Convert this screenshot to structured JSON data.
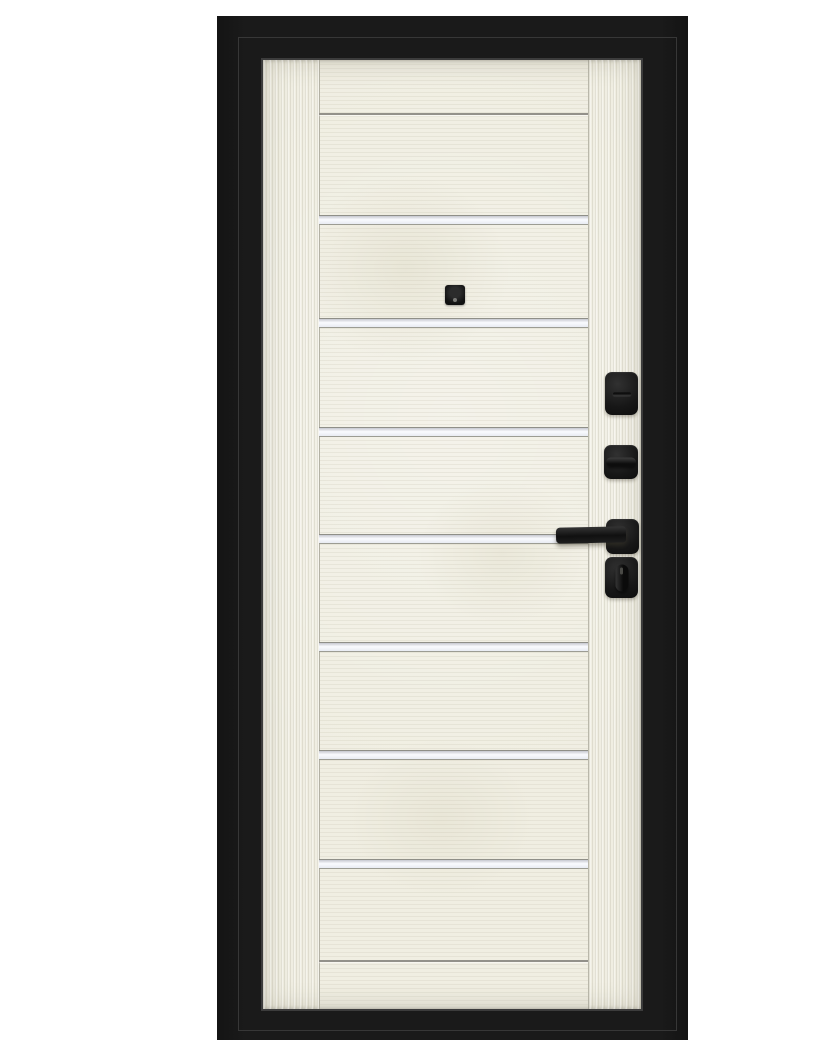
{
  "scene": {
    "description": "Product photo of an entrance door: black steel frame, light bleached-oak leaf with vertical side stiles, horizontal panel grooves with glossy light insert strips, square black peephole and four pieces of square black hardware (keyhole cover, thumbturn, lever handle, key cylinder) on the right stile"
  },
  "palette": {
    "background": "#ffffff",
    "frame": "#1a1a1a",
    "frame_highlight": "#3d3d3d",
    "wood": "#f0eee2",
    "groove_line": "#93918a",
    "insert_strip": "#fafbfe",
    "hardware": "#171717"
  },
  "door": {
    "leaf": {
      "x": 223,
      "y": 44,
      "w": 378,
      "h": 949
    },
    "stile_width_left": 56,
    "stile_width_right": 53,
    "grooves": [
      {
        "y": 97,
        "insert": false
      },
      {
        "y": 199,
        "insert": true
      },
      {
        "y": 302,
        "insert": true
      },
      {
        "y": 411,
        "insert": true
      },
      {
        "y": 518,
        "insert": true
      },
      {
        "y": 626,
        "insert": true
      },
      {
        "y": 734,
        "insert": true
      },
      {
        "y": 843,
        "insert": true
      },
      {
        "y": 944,
        "insert": false
      }
    ],
    "peephole": {
      "x": 405,
      "y": 269,
      "w": 20,
      "h": 20
    },
    "hardware": [
      {
        "name": "keyhole-escutcheon",
        "type": "keyhole",
        "x": 565,
        "y": 356,
        "w": 33,
        "h": 43
      },
      {
        "name": "thumbturn-escutcheon",
        "type": "thumbturn",
        "x": 564,
        "y": 429,
        "w": 34,
        "h": 34
      },
      {
        "name": "lever-handle-rose",
        "type": "handle",
        "x": 566,
        "y": 503,
        "w": 33,
        "h": 35,
        "lever": {
          "x": 516,
          "y": 511,
          "w": 70,
          "h": 16
        }
      },
      {
        "name": "cylinder-escutcheon",
        "type": "cylinder",
        "x": 565,
        "y": 541,
        "w": 33,
        "h": 41
      }
    ]
  }
}
